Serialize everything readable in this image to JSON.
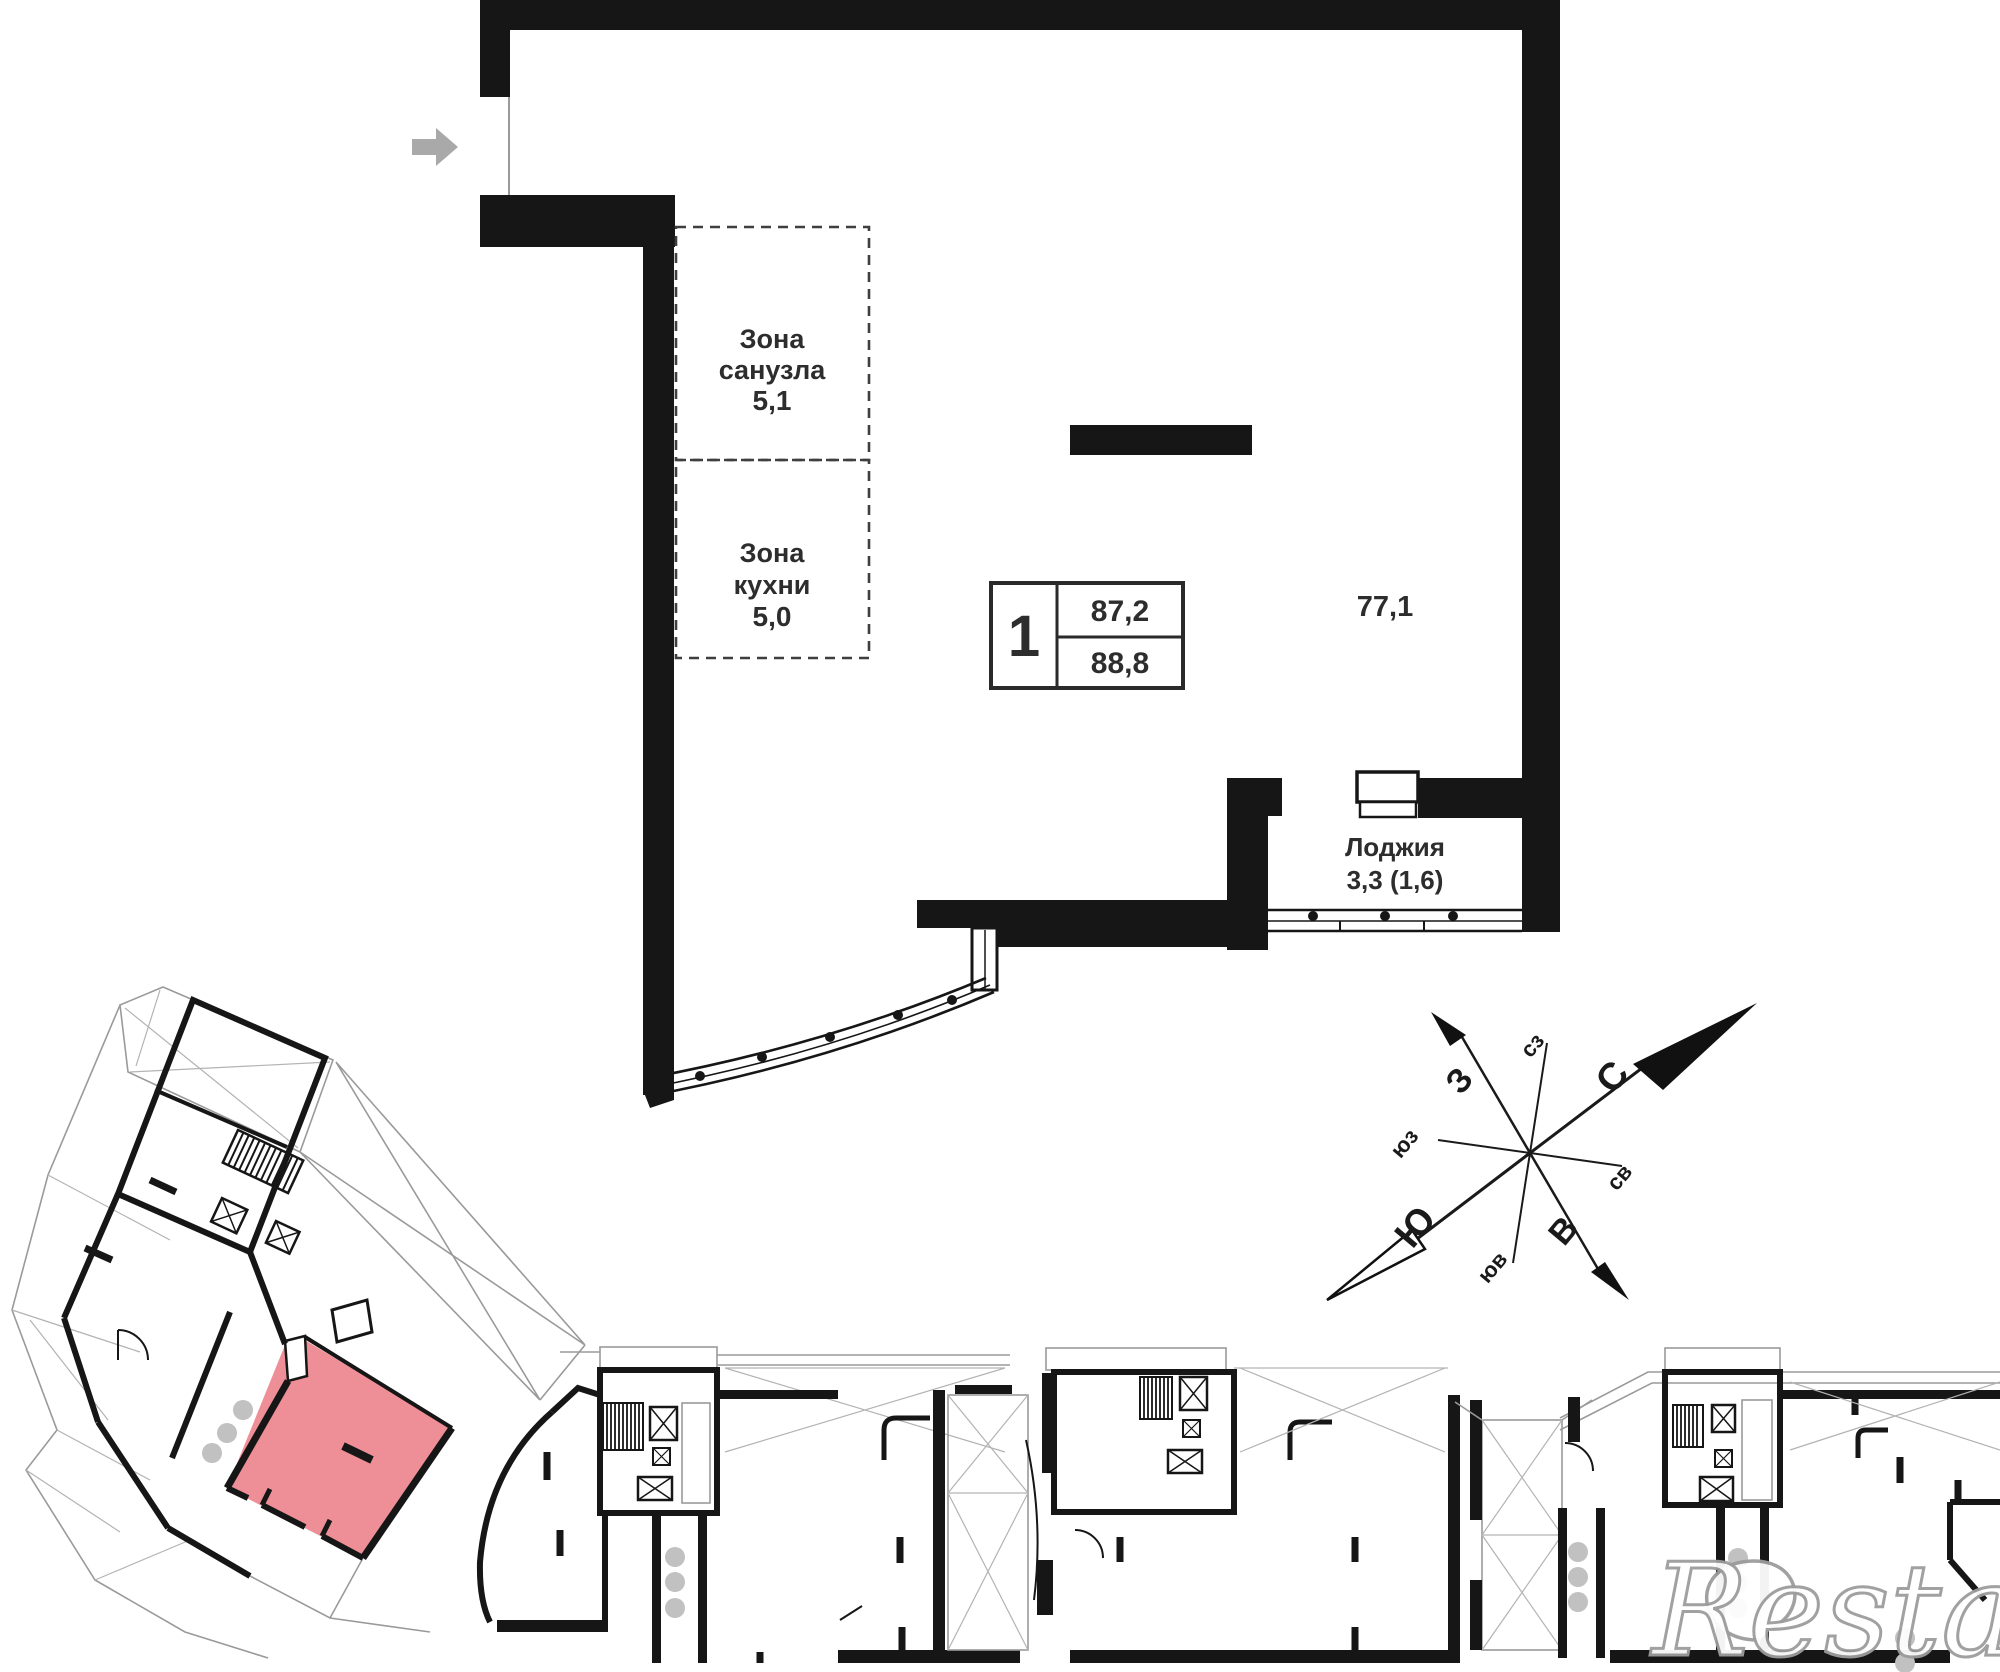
{
  "plan": {
    "zones": {
      "bathroom": {
        "title_lines": [
          "Зона",
          "санузла"
        ],
        "area": "5,1"
      },
      "kitchen": {
        "title_lines": [
          "Зона",
          "кухни"
        ],
        "area": "5,0"
      }
    },
    "summary": {
      "rooms": "1",
      "area_main": "87,2",
      "area_total": "88,8"
    },
    "room_area": "77,1",
    "loggia": {
      "label": "Лоджия",
      "area": "3,3 (1,6)"
    }
  },
  "compass": {
    "north": "С",
    "south": "Ю",
    "west": "З",
    "east": "В",
    "northwest": "сз",
    "northeast": "св",
    "southwest": "юз",
    "southeast": "юв"
  },
  "watermark": "Restate",
  "icons": {
    "entry": "entry-arrow-right"
  },
  "colors": {
    "highlight_unit": "#ee8f97",
    "walls": "#161616",
    "thin_lines": "#9a9a9a",
    "dashed_zone": "#3f3f3f",
    "dots": "#c1c1c1",
    "entry_arrow": "#a9a9a9",
    "text": "#2d2d2d",
    "watermark_stroke": "#9c9c9c"
  }
}
